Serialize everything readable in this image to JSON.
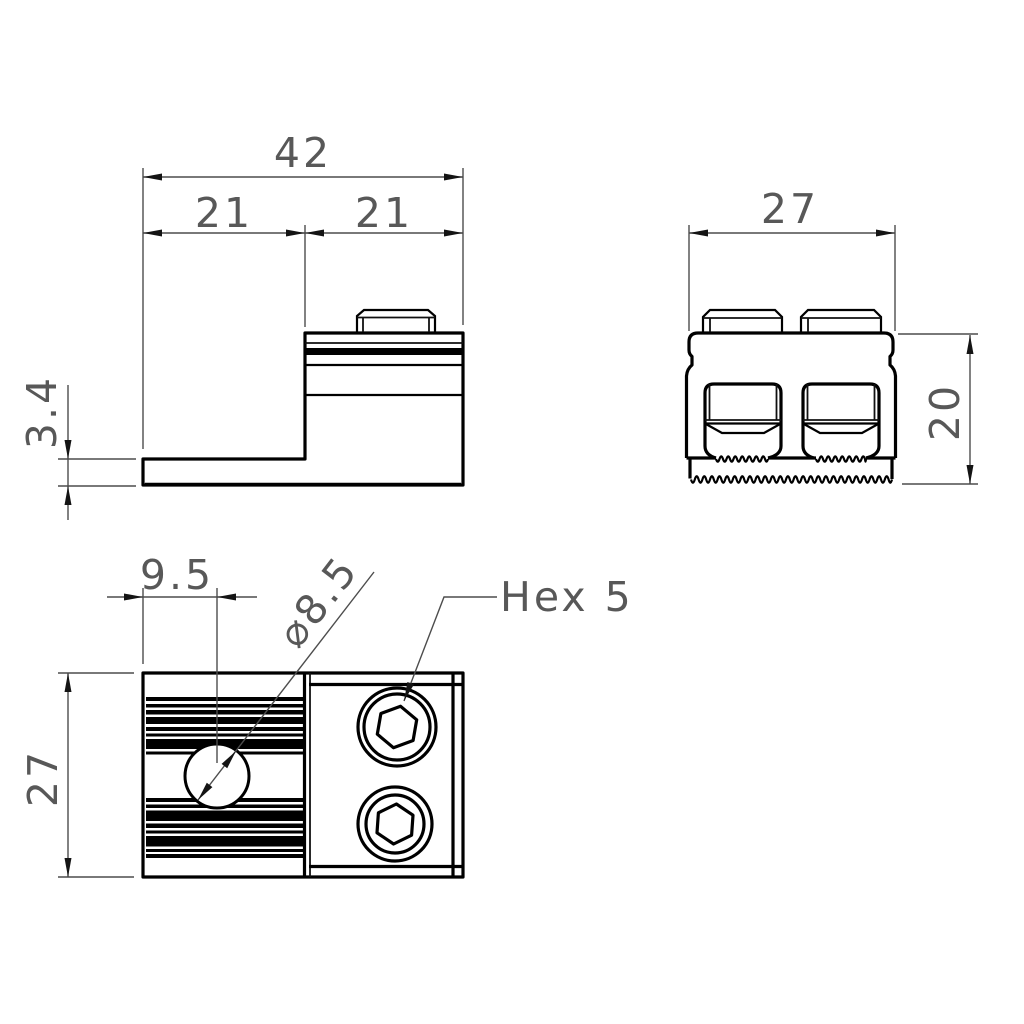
{
  "drawing": {
    "background": "#ffffff",
    "line_color": "#000000",
    "dim_line_color": "#4d4d4d",
    "text_color": "#585858"
  },
  "side_view": {
    "dim_total_width": "42",
    "dim_left_half": "21",
    "dim_right_half": "21",
    "dim_flange_height": "3.4"
  },
  "front_view": {
    "dim_width": "27",
    "dim_height": "20"
  },
  "top_view": {
    "dim_hole_offset": "9.5",
    "dim_hole_diameter": "⌀8.5",
    "dim_socket_label": "Hex 5",
    "dim_depth": "27"
  }
}
